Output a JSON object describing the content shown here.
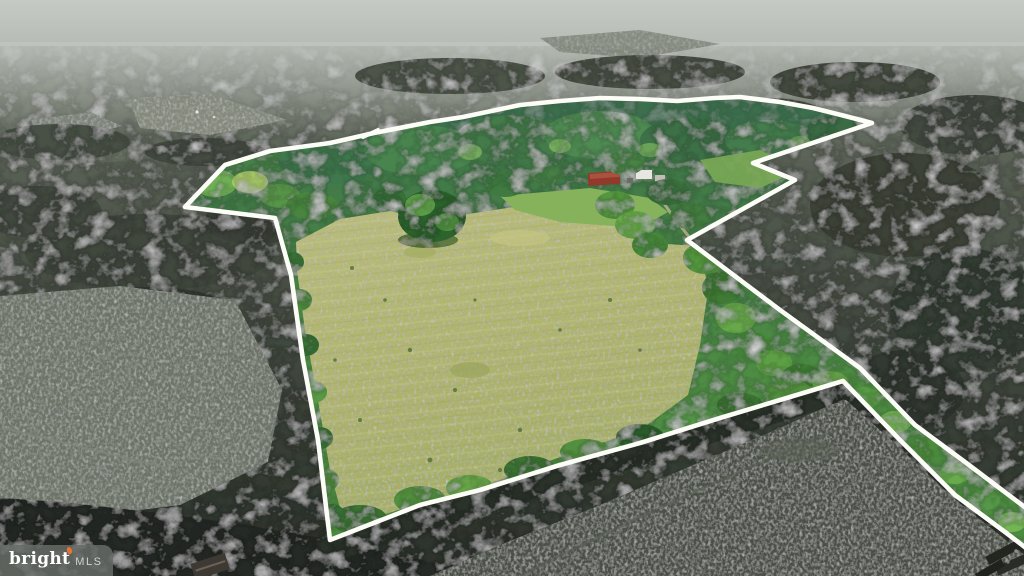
{
  "scene": {
    "kind": "aerial-drone-photograph",
    "subject": "wooded rural land parcel with white property-boundary outline; interior shown bright, surroundings dimmed",
    "interior_features": "large yellow-green meadow, green woods, farmstead with red barn and white outbuilding",
    "exterior_features": "dimmed gray-green forest, open gray fields left and bottom-right, hazy sky at horizon"
  },
  "boundary": {
    "color": "#fdfdf8",
    "points": "1026,548 1005,532 955,495 900,440 843,381 790,397 720,418 640,443 560,465 480,490 420,505 330,540 318,440 303,360 291,275 275,218 185,207 225,165 270,151 330,143 374,133 430,122 463,117 520,105 560,101 600,98 640,99 677,101 715,98 740,97 780,102 813,108 845,116 872,123 753,163 795,180 687,240 780,310 860,368 915,425 965,462 1026,508",
    "jog_points": "363,137 378,130"
  },
  "watermark": {
    "brand": "bright",
    "suffix": "MLS",
    "flame_color": "#e8742f",
    "bg_color": "#676b67"
  },
  "palette": {
    "sky": "#c3c7c1",
    "dim_forest_far": "#6a7165",
    "dim_forest_near": "#2c322b",
    "dim_field": "#6d7468",
    "dim_field_dark": "#4b5146",
    "bright_forest": "#47804a",
    "meadow": "#b4b96c",
    "farm_lawn": "#86b25c",
    "barn_red": "#93392b",
    "building_white": "#e8e6e0"
  }
}
